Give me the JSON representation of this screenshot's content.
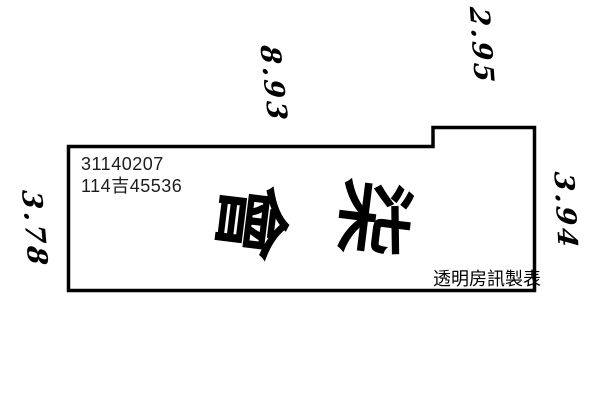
{
  "plan": {
    "registration_number": "31140207",
    "document_number": "114吉45536",
    "annotation_char_left": "會",
    "annotation_char_right": "柒",
    "dimensions": {
      "top": "8.93",
      "top_right": "2.95",
      "right": "3.94",
      "left": "3.78"
    },
    "credit": "透明房訊製表",
    "colors": {
      "outline": "#000000",
      "text": "#1c1c1c",
      "handwriting": "#000000",
      "background": "#ffffff"
    }
  }
}
